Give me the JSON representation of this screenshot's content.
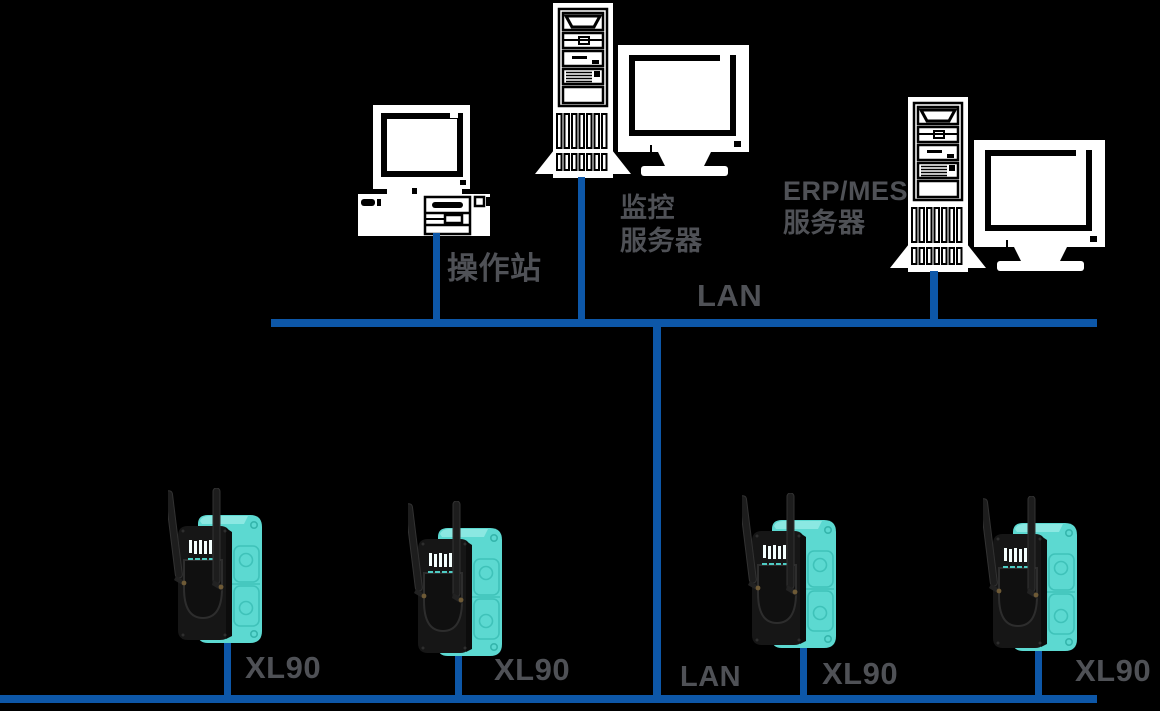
{
  "diagram": {
    "title_hint": "industrial wireless network topology",
    "background_color": "#000000",
    "colors": {
      "lan_line_blue": "#0D57A8",
      "label_gray": "#4F5156",
      "device_teal": "#5CD9D1",
      "artwork_white": "#FFFFFF"
    },
    "top_row": {
      "operator_station": {
        "label": "操作站"
      },
      "monitoring_server": {
        "label_line1": "监控",
        "label_line2": "服务器"
      },
      "erp_mes_server": {
        "label_line1": "ERP/MES",
        "label_line2": "服务器"
      }
    },
    "lan_top": {
      "label": "LAN"
    },
    "lan_bottom": {
      "label": "LAN"
    },
    "wireless_devices": [
      {
        "label": "XL90"
      },
      {
        "label": "XL90"
      },
      {
        "label": "XL90"
      },
      {
        "label": "XL90"
      }
    ]
  }
}
